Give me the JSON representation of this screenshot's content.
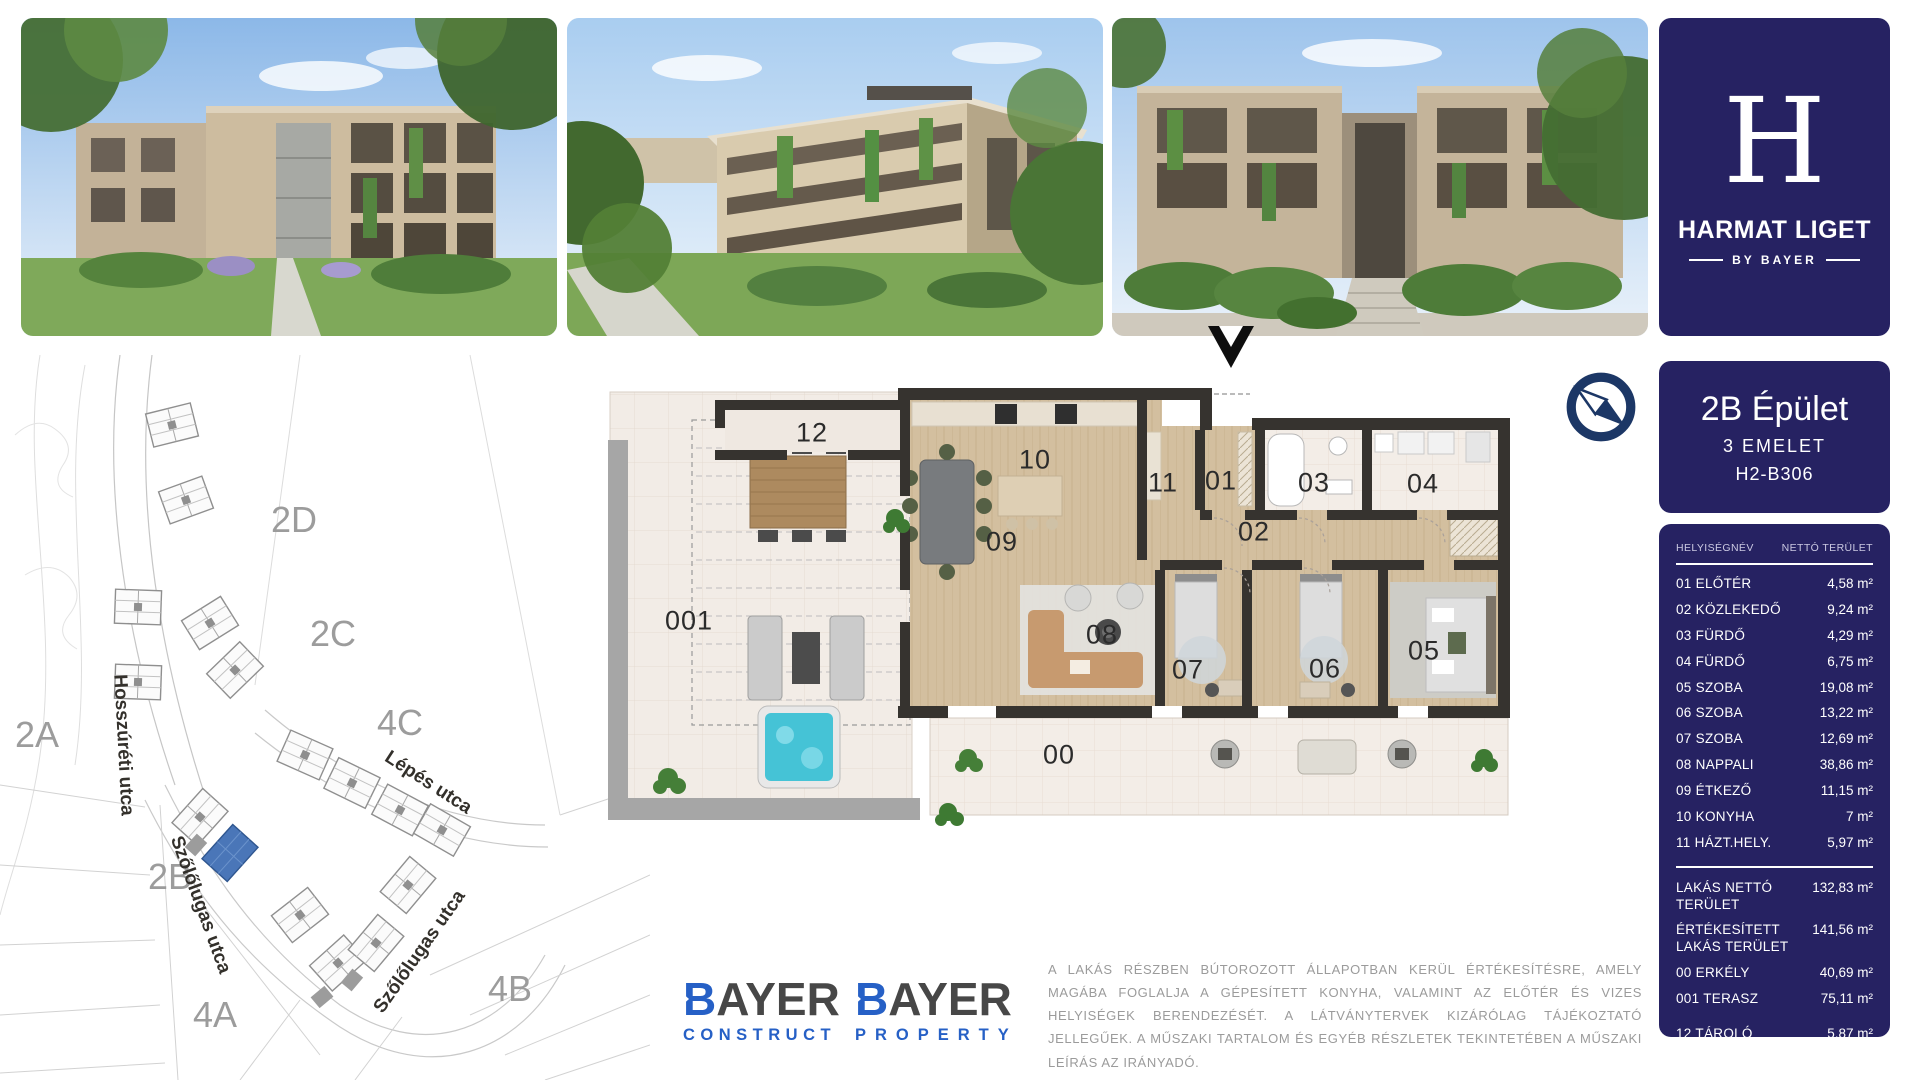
{
  "brand": {
    "letter": "H",
    "title": "HARMAT LIGET",
    "tagline": "BY BAYER"
  },
  "photos": [
    {
      "label": "courtyard-garden-render"
    },
    {
      "label": "corner-facade-render"
    },
    {
      "label": "street-entrance-render"
    }
  ],
  "unit": {
    "building": "2B Épület",
    "floor": "3 EMELET",
    "code": "H2-B306"
  },
  "table": {
    "col_name": "HELYISÉGNÉV",
    "col_area": "NETTÓ TERÜLET",
    "rows": [
      {
        "name": "01 ELŐTÉR",
        "area": "4,58 m²"
      },
      {
        "name": "02 KÖZLEKEDŐ",
        "area": "9,24 m²"
      },
      {
        "name": "03 FÜRDŐ",
        "area": "4,29 m²"
      },
      {
        "name": "04 FÜRDŐ",
        "area": "6,75 m²"
      },
      {
        "name": "05 SZOBA",
        "area": "19,08 m²"
      },
      {
        "name": "06 SZOBA",
        "area": "13,22 m²"
      },
      {
        "name": "07 SZOBA",
        "area": "12,69 m²"
      },
      {
        "name": "08 NAPPALI",
        "area": "38,86 m²"
      },
      {
        "name": "09 ÉTKEZŐ",
        "area": "11,15 m²"
      },
      {
        "name": "10 KONYHA",
        "area": "7 m²"
      },
      {
        "name": "11 HÁZT.HELY.",
        "area": "5,97 m²"
      }
    ],
    "summary": [
      {
        "name": "LAKÁS NETTÓ TERÜLET",
        "area": "132,83 m²"
      },
      {
        "name": "ÉRTÉKESÍTETT LAKÁS TERÜLET",
        "area": "141,56 m²"
      },
      {
        "name": "00 ERKÉLY",
        "area": "40,69 m²"
      },
      {
        "name": "001 TERASZ",
        "area": "75,11 m²"
      },
      {
        "name": "12 TÁROLÓ",
        "area": "5,87 m²"
      }
    ]
  },
  "plan": {
    "labels": [
      "12",
      "10",
      "11",
      "01",
      "03",
      "04",
      "02",
      "09",
      "001",
      "08",
      "07",
      "06",
      "05",
      "00"
    ]
  },
  "map": {
    "areas": [
      "2D",
      "2C",
      "2A",
      "4C",
      "2B",
      "4A",
      "4B"
    ],
    "streets": [
      "Hosszúréti utca",
      "Lépés utca",
      "Szőlőlugas utca",
      "Szőlőlugas utca"
    ],
    "highlight": "#4a76b8"
  },
  "footer": {
    "logo1": {
      "b": "B",
      "rest": "AYER",
      "sub": "CONSTRUCT"
    },
    "logo2": {
      "b": "B",
      "rest": "AYER",
      "sub": "PROPERTY"
    },
    "disclaimer": "A LAKÁS RÉSZBEN BÚTOROZOTT ÁLLAPOTBAN KERÜL ÉRTÉKESÍTÉSRE, AMELY MAGÁBA FOGLALJA A GÉPESÍTETT KONYHA, VALAMINT AZ ELŐTÉR ÉS VIZES HELYISÉGEK BERENDEZÉSÉT. A LÁTVÁNYTERVEK KIZÁRÓLAG TÁJÉKOZTATÓ JELLEGŰEK. A MŰSZAKI TARTALOM ÉS EGYÉB RÉSZLETEK TEKINTETÉBEN A MŰSZAKI LEÍRÁS AZ IRÁNYADÓ."
  },
  "colors": {
    "navy": "#262262",
    "blue": "#2660c6"
  }
}
